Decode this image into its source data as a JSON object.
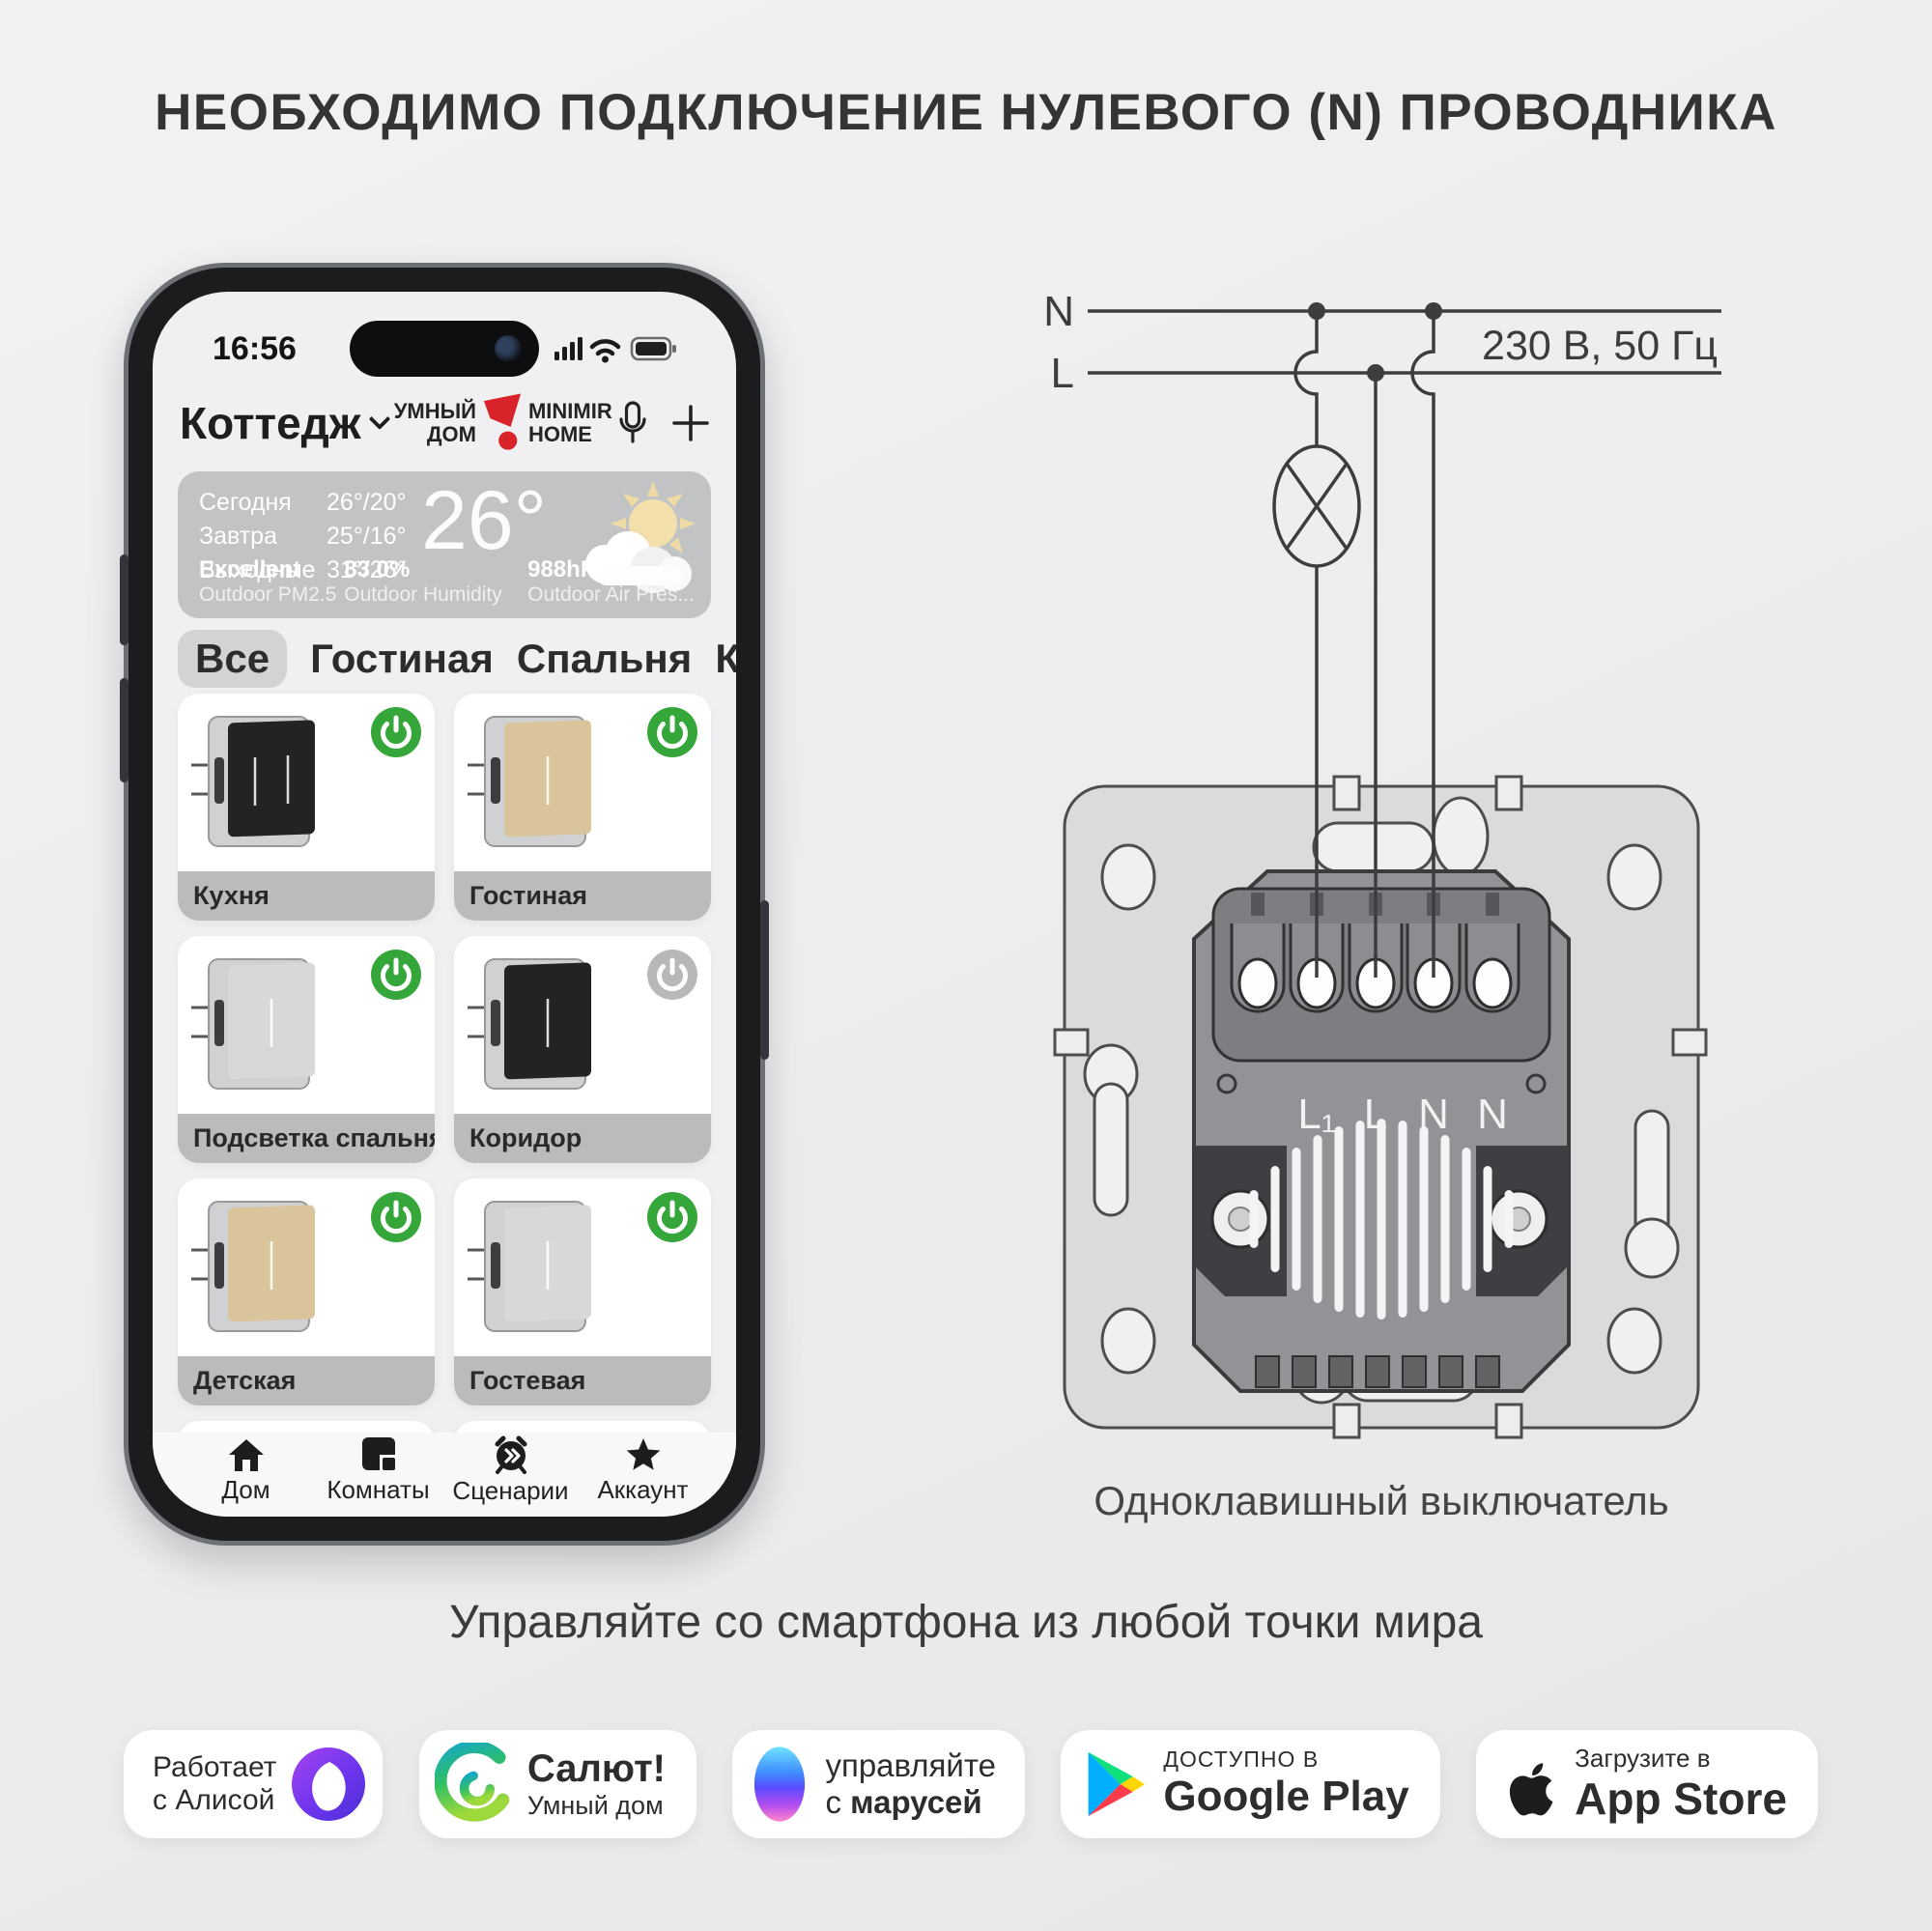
{
  "title": "НЕОБХОДИМО ПОДКЛЮЧЕНИЕ НУЛЕВОГО (N) ПРОВОДНИКА",
  "tagline": "Управляйте со смартфона из любой точки мира",
  "colors": {
    "accent_green": "#35a639",
    "power_off_gray": "#b8b8ba",
    "brand_red": "#d8232a",
    "device_black": "#232325",
    "device_gold": "#d9c49c",
    "device_silver": "#d8d8da"
  },
  "phone": {
    "status": {
      "time": "16:56"
    },
    "header": {
      "home_name": "Коттедж",
      "brand_l1": "УМНЫЙ",
      "brand_l2": "ДОМ",
      "brand_r1": "MINIMIR",
      "brand_r2": "HOME"
    },
    "weather": {
      "rows": [
        {
          "label": "Сегодня",
          "temp": "26°/20°"
        },
        {
          "label": "Завтра",
          "temp": "25°/16°"
        },
        {
          "label": "Выходные",
          "temp": "31°/26°"
        }
      ],
      "current": "26°",
      "stats": [
        {
          "value": "Excellent",
          "label": "Outdoor PM2.5"
        },
        {
          "value": "83.0%",
          "label": "Outdoor Humidity"
        },
        {
          "value": "988hPa",
          "label": "Outdoor Air Pres..."
        }
      ]
    },
    "tabs": [
      {
        "label": "Все"
      },
      {
        "label": "Гостиная"
      },
      {
        "label": "Спальня"
      },
      {
        "label": "Коридор"
      }
    ],
    "devices": [
      {
        "name": "Кухня",
        "panel_color": "#232325",
        "power_color": "#35a639"
      },
      {
        "name": "Гостиная",
        "panel_color": "#d9c49c",
        "power_color": "#35a639"
      },
      {
        "name": "Подсветка спальня",
        "panel_color": "#d8d8da",
        "power_color": "#35a639"
      },
      {
        "name": "Коридор",
        "panel_color": "#232325",
        "power_color": "#b8b8ba"
      },
      {
        "name": "Детская",
        "panel_color": "#d9c49c",
        "power_color": "#35a639"
      },
      {
        "name": "Гостевая",
        "panel_color": "#d8d8da",
        "power_color": "#35a639"
      }
    ],
    "nav": [
      {
        "label": "Дом"
      },
      {
        "label": "Комнаты"
      },
      {
        "label": "Сценарии"
      },
      {
        "label": "Аккаунт"
      }
    ]
  },
  "diagram": {
    "n_label": "N",
    "l_label": "L",
    "power_label": "230 В, 50 Гц",
    "terminals": [
      "L₁",
      "L",
      "N",
      "N"
    ],
    "caption": "Одноклавишный выключатель"
  },
  "badges": [
    {
      "line1": "Работает",
      "line2": "с Алисой"
    },
    {
      "line1": "Салют!",
      "line2": "Умный дом"
    },
    {
      "line1": "управляйте",
      "line2_prefix": "с ",
      "line2_bold": "марусей"
    },
    {
      "line1": "ДОСТУПНО В",
      "line2": "Google Play"
    },
    {
      "line1": "Загрузите в",
      "line2": "App Store"
    }
  ]
}
